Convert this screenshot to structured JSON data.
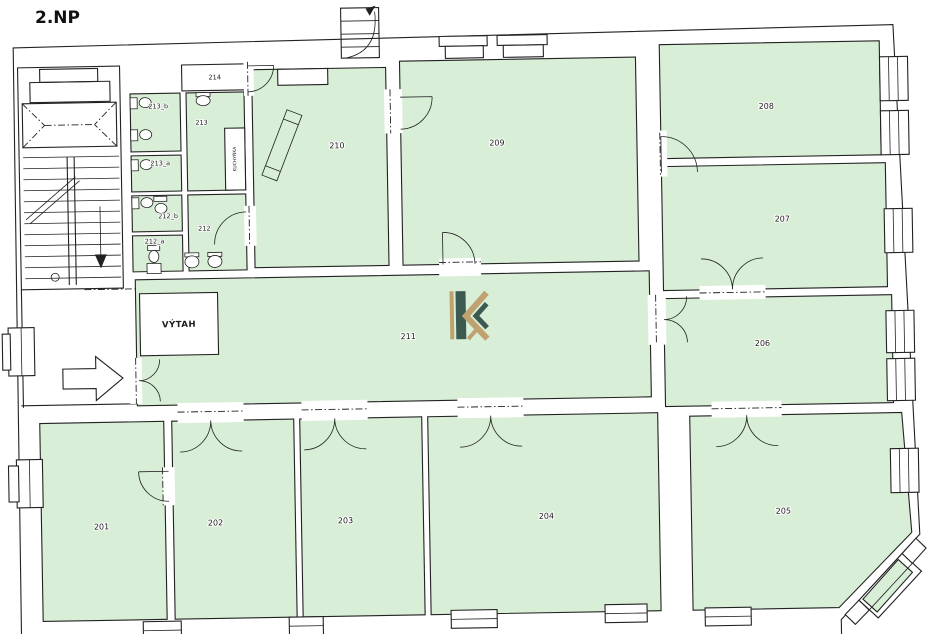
{
  "title": "2.NP",
  "colors": {
    "room_fill": "#d8eed6",
    "wall_fill": "#ffffff",
    "line": "#222222",
    "logo_dark": "#3d5a50",
    "logo_gold": "#bfa26f"
  },
  "rooms": {
    "r201": "201",
    "r202": "202",
    "r203": "203",
    "r204": "204",
    "r205": "205",
    "r206": "206",
    "r207": "207",
    "r208": "208",
    "r209": "209",
    "r210": "210",
    "r211": "211",
    "r212": "212",
    "r212_a": "212_a",
    "r212_b": "212_b",
    "r213": "213",
    "r213_a": "213_a",
    "r213_b": "213_b",
    "r214": "214"
  },
  "labels": {
    "elevator": "VÝTAH",
    "shaft": "KUCHYŇKA"
  }
}
